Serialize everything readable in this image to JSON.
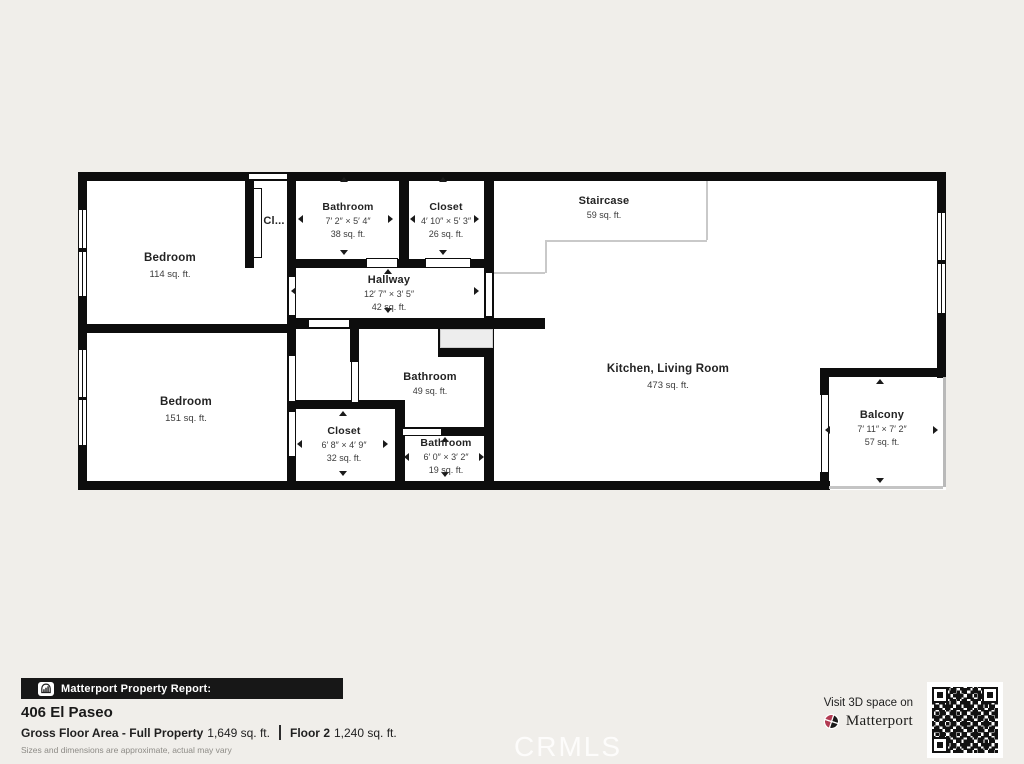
{
  "page": {
    "watermark": "CRMLS",
    "background": "#f0eeea"
  },
  "plan": {
    "rooms": [
      {
        "id": "bedroom-1",
        "name": "Bedroom",
        "area": "114 sq. ft."
      },
      {
        "id": "closet-hall",
        "name": "Cl..."
      },
      {
        "id": "bathroom-1",
        "name": "Bathroom",
        "dims": "7′ 2″ × 5′ 4″",
        "area": "38 sq. ft."
      },
      {
        "id": "closet-1",
        "name": "Closet",
        "dims": "4′ 10″ × 5′ 3″",
        "area": "26 sq. ft."
      },
      {
        "id": "staircase",
        "name": "Staircase",
        "area": "59 sq. ft."
      },
      {
        "id": "hallway",
        "name": "Hallway",
        "dims": "12′ 7″ × 3′ 5″",
        "area": "42 sq. ft."
      },
      {
        "id": "bedroom-2",
        "name": "Bedroom",
        "area": "151 sq. ft."
      },
      {
        "id": "bathroom-2",
        "name": "Bathroom",
        "area": "49 sq. ft."
      },
      {
        "id": "closet-2",
        "name": "Closet",
        "dims": "6′ 8″ × 4′ 9″",
        "area": "32 sq. ft."
      },
      {
        "id": "bathroom-3",
        "name": "Bathroom",
        "dims": "6′ 0″ × 3′ 2″",
        "area": "19 sq. ft."
      },
      {
        "id": "kitchen-living",
        "name": "Kitchen, Living Room",
        "area": "473 sq. ft."
      },
      {
        "id": "balcony",
        "name": "Balcony",
        "dims": "7′ 11″ × 7′ 2″",
        "area": "57 sq. ft."
      }
    ]
  },
  "footer": {
    "report_label": "Matterport Property Report:",
    "address": "406 El Paseo",
    "gross_floor_label": "Gross Floor Area - Full Property",
    "gross_floor_value": "1,649 sq. ft.",
    "floor2_label": "Floor 2",
    "floor2_value": "1,240 sq. ft.",
    "disclaimer": "Sizes and dimensions are approximate, actual may vary",
    "visit_text": "Visit 3D space on",
    "brand_name": "Matterport"
  },
  "colors": {
    "wall": "#0d0d0d",
    "logo_red": "#b23a52",
    "logo_black": "#1a1a1a"
  }
}
